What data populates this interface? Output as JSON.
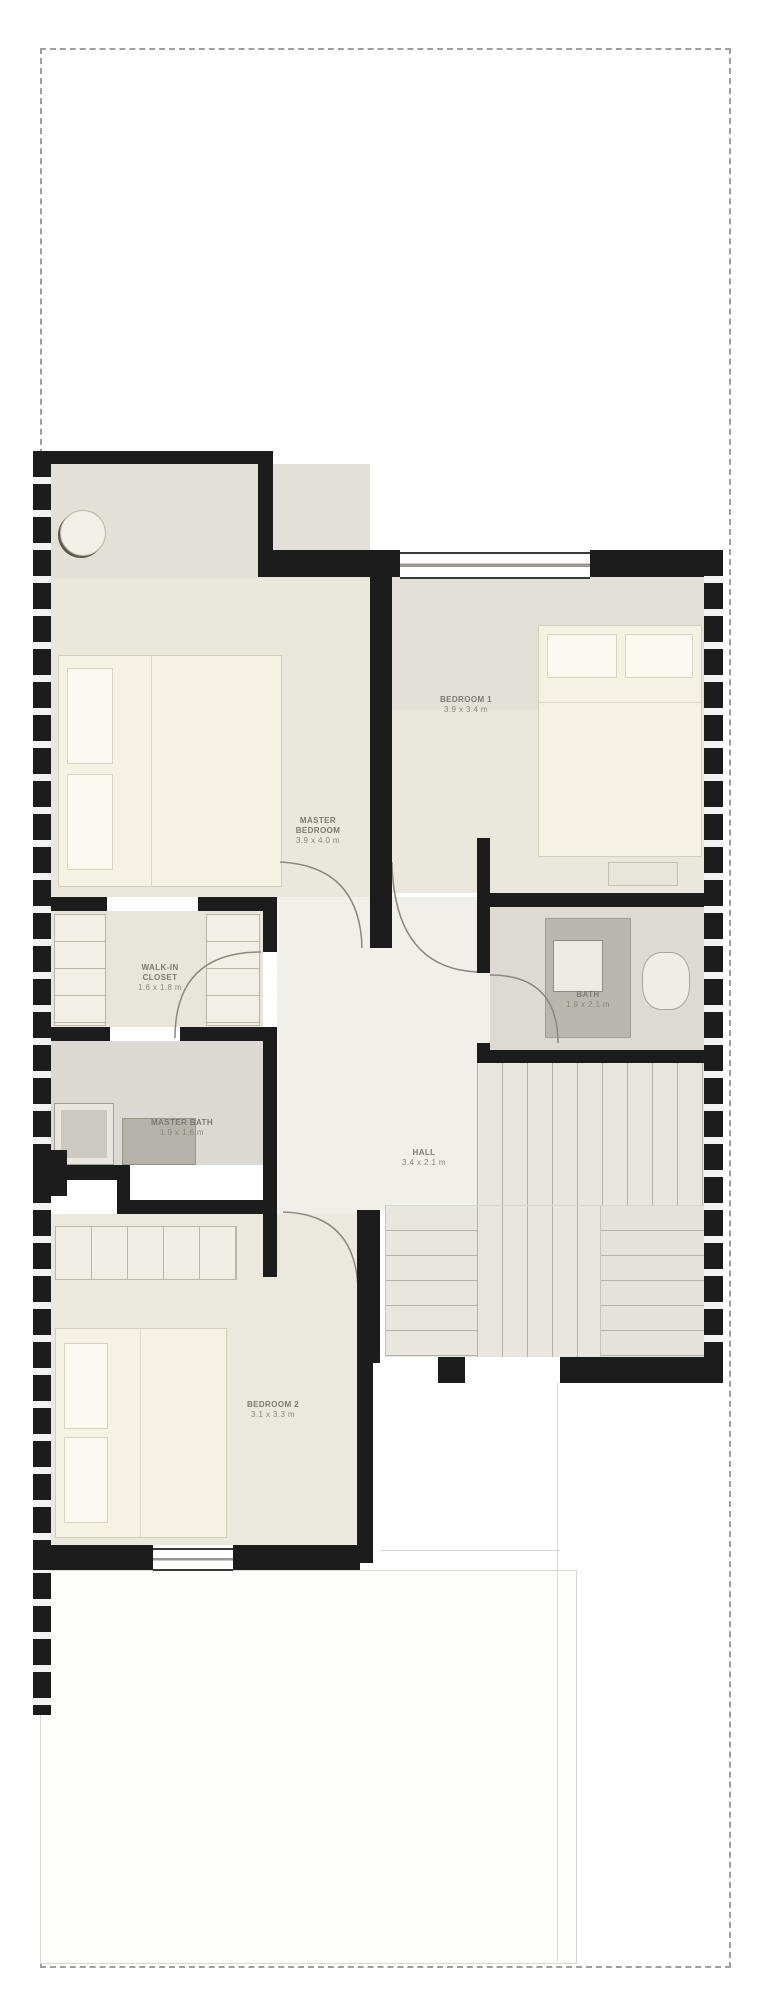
{
  "document": {
    "kind": "floor-plan",
    "border_style": "dash-dot boundary rectangle"
  },
  "colors": {
    "wall": "#1c1c1c",
    "floor_warm": "#eae7dd",
    "floor_grey_band": "#e3e0d8",
    "closet_floor": "#e8e5db",
    "tile_floor": "#dcdad2",
    "hall_floor": "#f0efe9",
    "stairs_floor": "#e8e6df",
    "bed_fill": "#f5f1e3",
    "fixture_grey": "#b7b5ad",
    "boundary_dash": "#9e9e9e",
    "label_text": "#7c7970"
  },
  "rooms": [
    {
      "id": "master-bedroom",
      "name_lines": [
        "MASTER",
        "BEDROOM"
      ],
      "dims": "3.9 x 4.0 m"
    },
    {
      "id": "bedroom-1",
      "name": "BEDROOM 1",
      "dims": "3.9 x 3.4 m"
    },
    {
      "id": "walk-in-closet",
      "name_lines": [
        "WALK-IN",
        "CLOSET"
      ],
      "dims": "1.6 x 1.8 m"
    },
    {
      "id": "master-bath",
      "name": "MASTER BATH",
      "dims": "1.9 x 1.6 m"
    },
    {
      "id": "bath",
      "name": "BATH",
      "dims": "1.9 x 2.1 m"
    },
    {
      "id": "hall",
      "name": "HALL",
      "dims": "3.4 x 2.1 m"
    },
    {
      "id": "bedroom-2",
      "name": "BEDROOM 2",
      "dims": "3.1 x 3.3 m"
    }
  ]
}
